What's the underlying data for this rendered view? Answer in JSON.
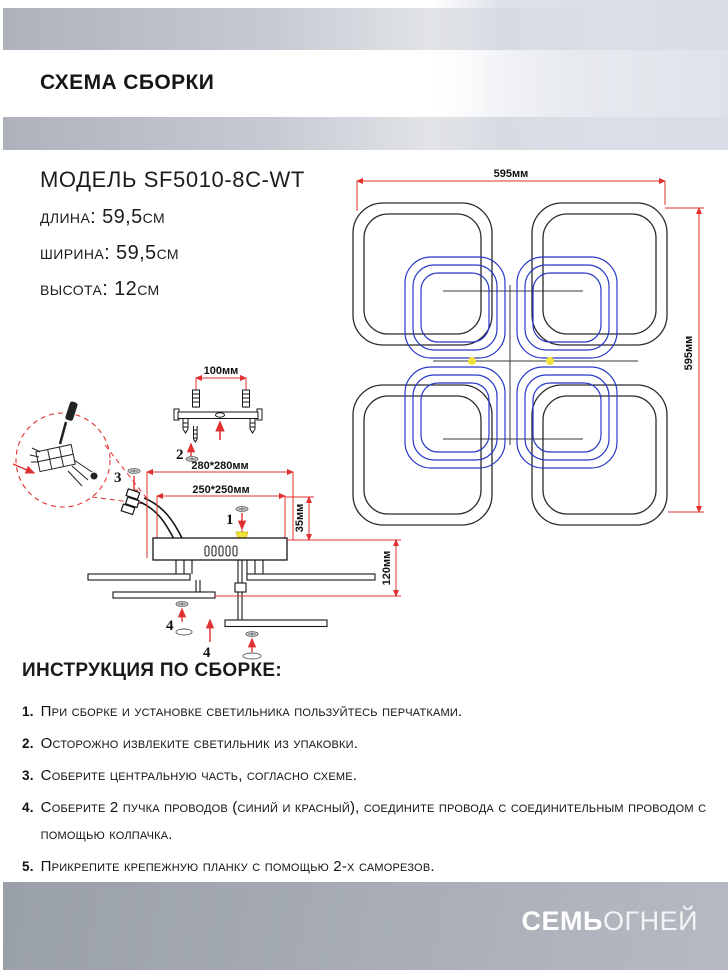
{
  "header": {
    "title": "СХЕМА СБОРКИ"
  },
  "model": {
    "title": "МОДЕЛЬ SF5010-8C-WT",
    "length": "длина: 59,5см",
    "width": "ширина: 59,5см",
    "height": "высота: 12см"
  },
  "top_view": {
    "width_label": "595мм",
    "height_label": "595мм"
  },
  "side_view": {
    "bracket_span": "100мм",
    "outer_dim": "280*280мм",
    "inner_dim": "250*250мм",
    "offset_dim": "35мм",
    "total_height": "120мм",
    "callout_1": "1",
    "callout_2": "2",
    "callout_3": "3",
    "callout_4": "4"
  },
  "instructions": {
    "title": "ИНСТРУКЦИЯ ПО СБОРКЕ:",
    "items": [
      {
        "num": "1.",
        "text": "При сборке и установке светильника пользуйтесь перчатками."
      },
      {
        "num": "2.",
        "text": "Осторожно извлеките светильник из упаковки."
      },
      {
        "num": "3.",
        "text": "Соберите центральную часть, согласно схеме."
      },
      {
        "num": "4.",
        "text": "Соберите 2 пучка проводов (синий и красный), соедините провода с соединительным проводом с помощью колпачка."
      },
      {
        "num": "5.",
        "text": "Прикрепите крепежную планку с помощью 2-х саморезов."
      },
      {
        "num": "6.",
        "text": "Соедините центральный провод с проводом электросети с помощью клемной колодки."
      }
    ]
  },
  "footer": {
    "brand_bold": "СЕМЬ",
    "brand_light": "ОГНЕЙ"
  },
  "colors": {
    "dimension_red": "#e03030",
    "led_blue": "#2737c8",
    "highlight_yellow": "#f2e23a",
    "line_black": "#2b2b2b",
    "header_gray": "#c6cad2",
    "footer_gray": "#a9aeb6"
  }
}
